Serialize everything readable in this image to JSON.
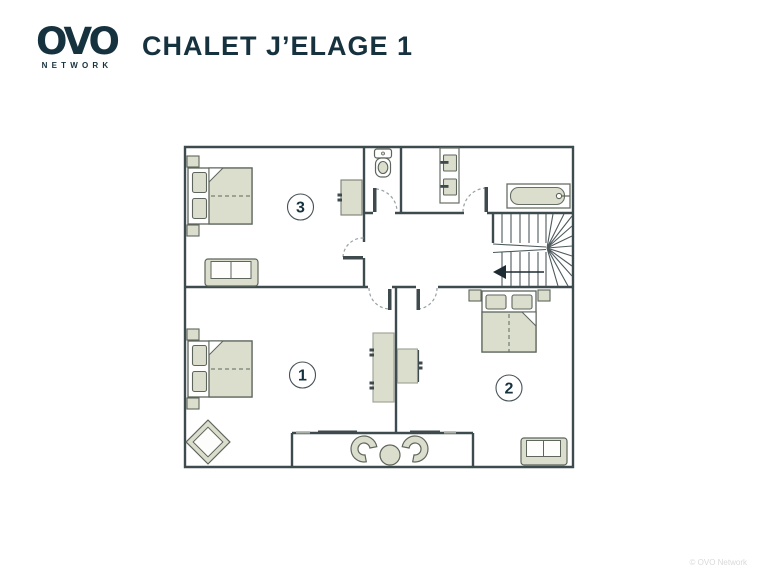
{
  "header": {
    "logo": {
      "text": "OVO",
      "subtext": "NETWORK"
    },
    "title": "CHALET J’ELAGE 1"
  },
  "floorplan": {
    "rooms": [
      {
        "number": "3",
        "name": "bedroom-3",
        "furniture": [
          "double-bed",
          "nightstand",
          "nightstand",
          "sofa",
          "wardrobe"
        ]
      },
      {
        "number": "1",
        "name": "bedroom-1",
        "furniture": [
          "double-bed",
          "nightstand",
          "nightstand",
          "armchair",
          "wardrobe"
        ]
      },
      {
        "number": "2",
        "name": "bedroom-2",
        "furniture": [
          "double-bed",
          "nightstand",
          "nightstand",
          "sofa",
          "desk"
        ]
      }
    ],
    "areas": [
      "wc",
      "bathroom",
      "hallway",
      "staircase",
      "balcony"
    ],
    "fixtures": [
      "toilet",
      "double-sink-vanity",
      "bathtub"
    ],
    "balcony_furniture": [
      "curved-armchair",
      "round-table",
      "curved-armchair"
    ]
  },
  "watermark": "© OVO Network",
  "colors": {
    "ink": "#16323f",
    "wall": "#3d4a4e",
    "furniture_fill": "#dcdecd",
    "furniture_stroke": "#5d655c",
    "watermark": "#d9d9d9"
  }
}
